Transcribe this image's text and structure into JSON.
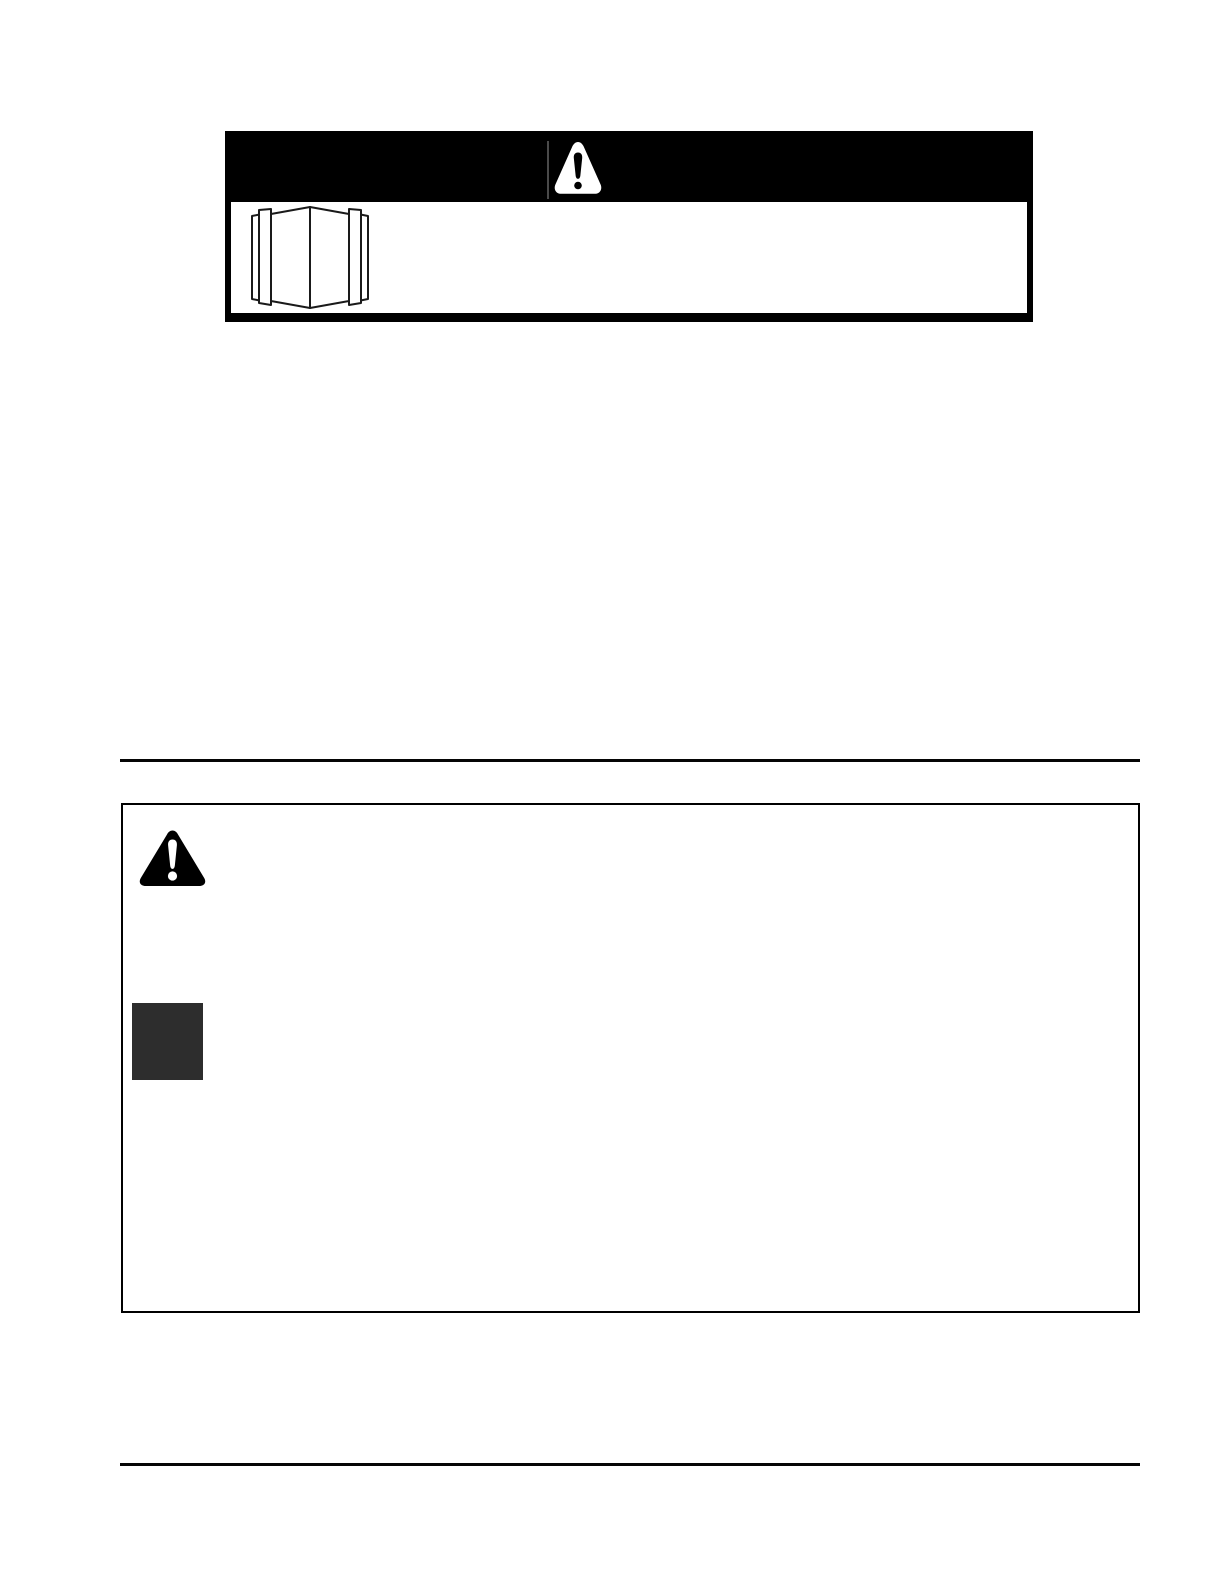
{
  "colors": {
    "paper": "#ffffff",
    "ink": "#000000",
    "banner": "#000000",
    "banner_seam": "#4a4a4a",
    "rule": "#050505",
    "square": "#2d2d2d",
    "icon_stroke": "#1a1a1a",
    "icon_fill": "#ffffff"
  },
  "top_warning_box": {
    "banner": {
      "icon": "alert-triangle-icon"
    },
    "body": {
      "icon": "open-book-icon"
    }
  },
  "safety_box": {
    "icon": "alert-triangle-icon",
    "marker": "dark-square-marker"
  }
}
